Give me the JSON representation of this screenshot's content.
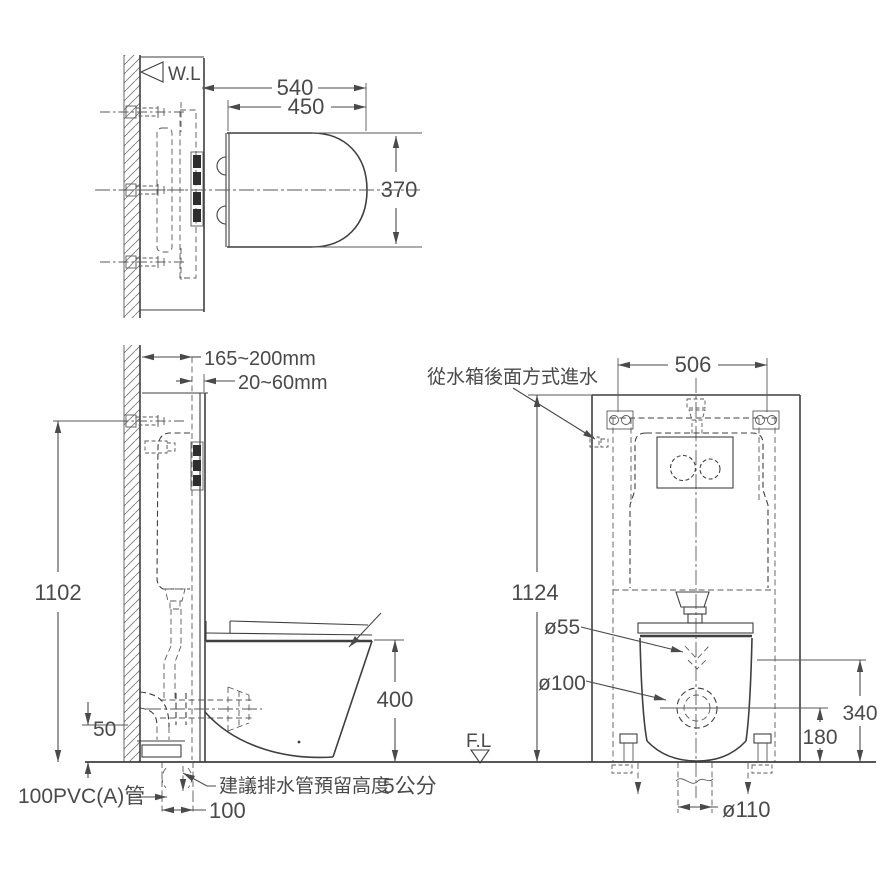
{
  "drawing": {
    "background_color": "#ffffff",
    "line_color": "#3f3f3f",
    "views": {
      "top": {
        "wall_line": "W.L",
        "overall_depth": "540",
        "seat_depth": "450",
        "seat_width": "370"
      },
      "side": {
        "wall_cavity_depth": "165~200mm",
        "panel_thickness": "20~60mm",
        "install_height": "1102",
        "bowl_height": "400",
        "drain_riser_height": "50",
        "drain_wall_offset": "100",
        "drain_pipe_label": "100PVC(A)管",
        "drain_note": "建議排水管預留高度",
        "drain_note_value": "5公分"
      },
      "front": {
        "inlet_note": "從水箱後面方式進水",
        "frame_width": "506",
        "frame_height": "1124",
        "flush_pipe_dia": "ø55",
        "drain_pipe_dia": "ø100",
        "rim_height": "340",
        "drain_center_height": "180",
        "floor_drain_dia": "ø110",
        "floor_line": "F.L"
      }
    }
  }
}
